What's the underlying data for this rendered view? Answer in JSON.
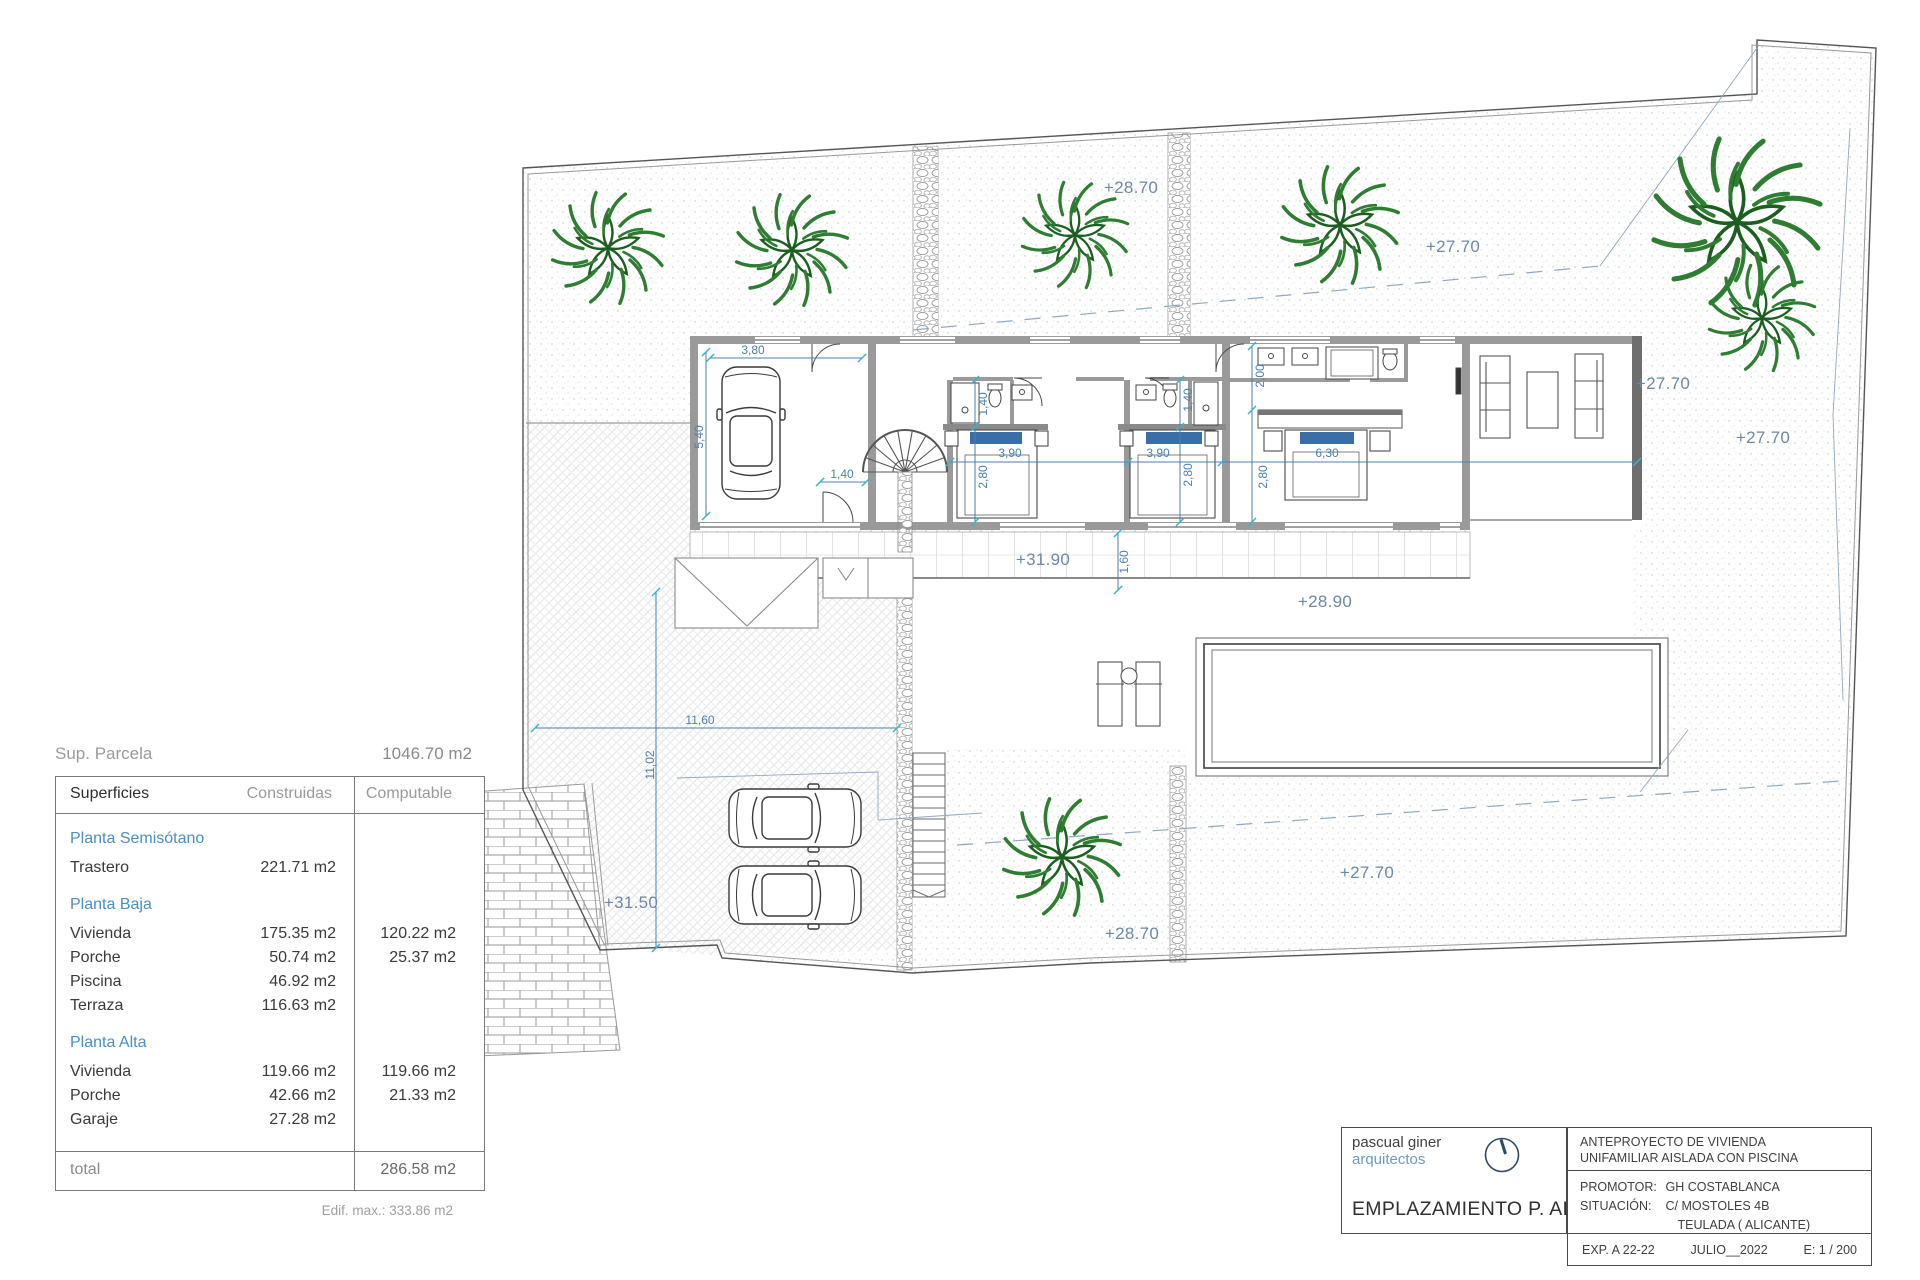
{
  "sheet": {
    "bg": "#ffffff"
  },
  "colors": {
    "elevation_text": "#6e88a6",
    "dimension_blue": "#4d7fae",
    "tick_cyan": "#35b6c9",
    "section_blue": "#4a8fc4",
    "wall_gray": "#9a9a9a",
    "tree_green": "#2e7d32",
    "pillow_blue": "#3a6ea8"
  },
  "summary": {
    "label": "Sup. Parcela",
    "value": "1046.70 m2"
  },
  "table": {
    "headers": {
      "col1": "Superficies",
      "col2": "Construidas",
      "col3": "Computable"
    },
    "sections": [
      {
        "title": "Planta Semisótano",
        "rows": [
          {
            "name": "Trastero",
            "construidas": "221.71 m2",
            "computable": ""
          }
        ]
      },
      {
        "title": "Planta Baja",
        "rows": [
          {
            "name": "Vivienda",
            "construidas": "175.35 m2",
            "computable": "120.22 m2"
          },
          {
            "name": "Porche",
            "construidas": "50.74 m2",
            "computable": "25.37 m2"
          },
          {
            "name": "Piscina",
            "construidas": "46.92 m2",
            "computable": ""
          },
          {
            "name": "Terraza",
            "construidas": "116.63 m2",
            "computable": ""
          }
        ]
      },
      {
        "title": "Planta Alta",
        "rows": [
          {
            "name": "Vivienda",
            "construidas": "119.66 m2",
            "computable": "119.66 m2"
          },
          {
            "name": "Porche",
            "construidas": "42.66 m2",
            "computable": "21.33 m2"
          },
          {
            "name": "Garaje",
            "construidas": "27.28 m2",
            "computable": ""
          }
        ]
      }
    ],
    "total": {
      "label": "total",
      "value": "286.58 m2"
    },
    "footnote": "Edif. max.: 333.86 m2"
  },
  "titleblock": {
    "firm_name": "pascual giner",
    "firm_sub": "arquitectos",
    "drawing_title": "EMPLAZAMIENTO P. ALTA",
    "project_line1": "ANTEPROYECTO  DE VIVIENDA",
    "project_line2": "UNIFAMILIAR AISLADA CON PISCINA",
    "promotor_label": "PROMOTOR:",
    "promotor_value": "GH COSTABLANCA",
    "situacion_label": "SITUACIÓN:",
    "situacion_value1": "C/ MOSTOLES 4B",
    "situacion_value2": "TEULADA  ( ALICANTE)",
    "exp": "EXP. A 22-22",
    "date": "JULIO__2022",
    "scale": "E: 1 / 200"
  },
  "plan": {
    "elevations": [
      {
        "t": "+28.70",
        "x": 1131,
        "y": 188
      },
      {
        "t": "+27.70",
        "x": 1453,
        "y": 247
      },
      {
        "t": "+27.70",
        "x": 1663,
        "y": 384
      },
      {
        "t": "+27.70",
        "x": 1763,
        "y": 438
      },
      {
        "t": "+31.90",
        "x": 1043,
        "y": 560
      },
      {
        "t": "+28.90",
        "x": 1325,
        "y": 602
      },
      {
        "t": "+31.50",
        "x": 631,
        "y": 903
      },
      {
        "t": "+27.70",
        "x": 1367,
        "y": 873
      },
      {
        "t": "+28.70",
        "x": 1132,
        "y": 934
      }
    ],
    "dimensions": [
      {
        "t": "3,80",
        "x": 753,
        "y": 350,
        "rot": 0
      },
      {
        "t": "5,40",
        "x": 699,
        "y": 437,
        "rot": -90
      },
      {
        "t": "1,40",
        "x": 842,
        "y": 474,
        "rot": 0
      },
      {
        "t": "1,40",
        "x": 983,
        "y": 404,
        "rot": -90
      },
      {
        "t": "3,90",
        "x": 1010,
        "y": 453,
        "rot": 0
      },
      {
        "t": "2,80",
        "x": 983,
        "y": 477,
        "rot": -90
      },
      {
        "t": "1,40",
        "x": 1188,
        "y": 400,
        "rot": -90
      },
      {
        "t": "3,90",
        "x": 1158,
        "y": 453,
        "rot": 0
      },
      {
        "t": "2,80",
        "x": 1188,
        "y": 475,
        "rot": -90
      },
      {
        "t": "2,00",
        "x": 1260,
        "y": 376,
        "rot": -90
      },
      {
        "t": "6,30",
        "x": 1327,
        "y": 453,
        "rot": 0
      },
      {
        "t": "2,80",
        "x": 1263,
        "y": 477,
        "rot": -90
      },
      {
        "t": "1,60",
        "x": 1124,
        "y": 562,
        "rot": -90
      },
      {
        "t": "11,60",
        "x": 700,
        "y": 720,
        "rot": 0
      },
      {
        "t": "11,02",
        "x": 650,
        "y": 765,
        "rot": -90
      }
    ],
    "trees": [
      {
        "x": 608,
        "y": 248,
        "s": 1.0
      },
      {
        "x": 792,
        "y": 250,
        "s": 1.0
      },
      {
        "x": 1075,
        "y": 235,
        "s": 0.95
      },
      {
        "x": 1340,
        "y": 225,
        "s": 1.05
      },
      {
        "x": 1737,
        "y": 222,
        "s": 1.5
      },
      {
        "x": 1762,
        "y": 318,
        "s": 0.95
      },
      {
        "x": 1062,
        "y": 857,
        "s": 1.05
      }
    ],
    "cars": [
      {
        "x": 751,
        "y": 433,
        "rot": 0
      },
      {
        "x": 795,
        "y": 818,
        "rot": 90
      },
      {
        "x": 795,
        "y": 895,
        "rot": 90
      }
    ]
  }
}
